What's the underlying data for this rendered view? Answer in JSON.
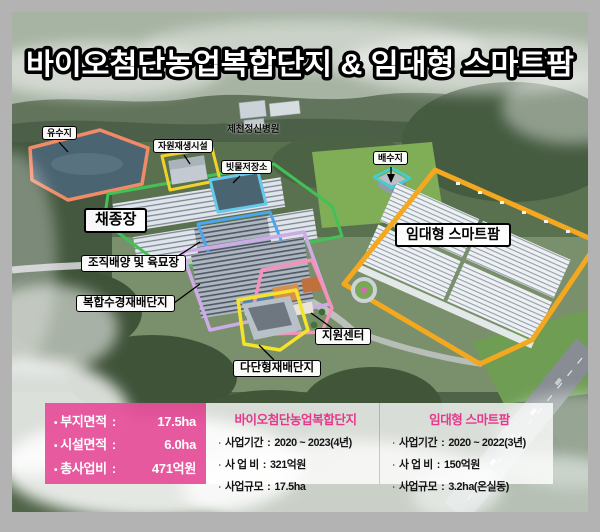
{
  "title": "바이오첨단농업복합단지 & 임대형 스마트팜",
  "ui": {
    "bullet_square": "•",
    "bullet_dot": "ㆍ",
    "colon": ":"
  },
  "zones": {
    "yusuji": {
      "label": "유수지",
      "color": "#f18a66"
    },
    "jawon": {
      "label": "자원재생시설",
      "color": "#f0d22b"
    },
    "hospital": {
      "label": "제천정신병원"
    },
    "bitmul": {
      "label": "빗물저장소",
      "color": "#66c9ea"
    },
    "chaejong": {
      "label": "채종장",
      "color": "#43c156"
    },
    "baesuji": {
      "label": "배수지",
      "color": "#3ecfd8"
    },
    "smartfarm": {
      "label": "임대형 스마트팜",
      "color": "#f3a81f"
    },
    "jojik": {
      "label": "조직배양 및 육묘장",
      "color": "#4ba6ec"
    },
    "bokhap": {
      "label": "복합수경재배단지",
      "color": "#cdabe6"
    },
    "jiwon": {
      "label": "지원센터",
      "color": "#f591bb"
    },
    "dadan": {
      "label": "다단형재배단지",
      "color": "#f3e32d"
    }
  },
  "summary_panel": {
    "bg_color": "#e7509a",
    "rows": [
      {
        "label": "부지면적",
        "value": "17.5ha"
      },
      {
        "label": "시설면적",
        "value": "6.0ha"
      },
      {
        "label": "총사업비",
        "value": "471억원"
      }
    ]
  },
  "detail_panels": [
    {
      "title": "바이오첨단농업복합단지",
      "title_color": "#e7378d",
      "rows": [
        {
          "label": "사업기간",
          "value": "2020 ~ 2023(4년)"
        },
        {
          "label": "사 업 비",
          "value": "321억원"
        },
        {
          "label": "사업규모",
          "value": "17.5ha"
        }
      ]
    },
    {
      "title": "임대형 스마트팜",
      "title_color": "#e7378d",
      "rows": [
        {
          "label": "사업기간",
          "value": "2020 ~ 2022(3년)"
        },
        {
          "label": "사 업 비",
          "value": "150억원"
        },
        {
          "label": "사업규모",
          "value": "3.2ha(온실동)"
        }
      ]
    }
  ]
}
